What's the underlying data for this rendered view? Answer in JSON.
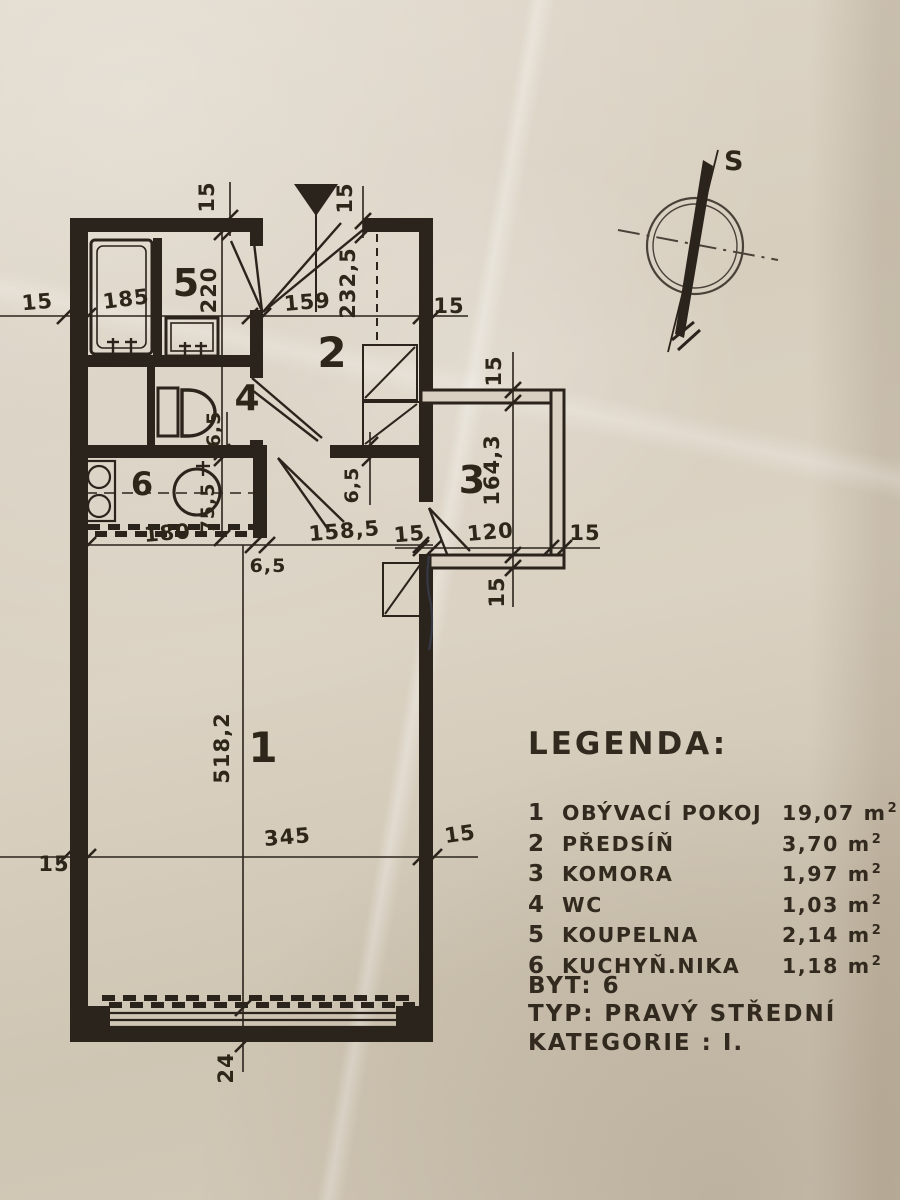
{
  "plan": {
    "rooms": [
      {
        "n": "1"
      },
      {
        "n": "2"
      },
      {
        "n": "3"
      },
      {
        "n": "4"
      },
      {
        "n": "5"
      },
      {
        "n": "6"
      }
    ],
    "dims": [
      {
        "t": "15"
      },
      {
        "t": "185"
      },
      {
        "t": "159"
      },
      {
        "t": "15"
      },
      {
        "t": "15"
      },
      {
        "t": "15"
      },
      {
        "t": "232,5"
      },
      {
        "t": "220"
      },
      {
        "t": "6,5"
      },
      {
        "t": "6,5"
      },
      {
        "t": "15"
      },
      {
        "t": "164,3"
      },
      {
        "t": "15"
      },
      {
        "t": "120"
      },
      {
        "t": "15"
      },
      {
        "t": "15"
      },
      {
        "t": "180"
      },
      {
        "t": "6,5"
      },
      {
        "t": "158,5"
      },
      {
        "t": "75,5"
      },
      {
        "t": "345"
      },
      {
        "t": "15"
      },
      {
        "t": "15"
      },
      {
        "t": "518,2"
      },
      {
        "t": "24"
      }
    ],
    "compass": {
      "label": "S"
    }
  },
  "legend": {
    "title": "LEGENDA:",
    "unit_base": "m",
    "unit_exp": "2",
    "items": [
      {
        "num": "1",
        "name": "OBÝVACÍ POKOJ",
        "area": "19,07"
      },
      {
        "num": "2",
        "name": "PŘEDSÍŇ",
        "area": "3,70"
      },
      {
        "num": "3",
        "name": "KOMORA",
        "area": "1,97"
      },
      {
        "num": "4",
        "name": "WC",
        "area": "1,03"
      },
      {
        "num": "5",
        "name": "KOUPELNA",
        "area": "2,14"
      },
      {
        "num": "6",
        "name": "KUCHYŇ.NIKA",
        "area": "1,18"
      }
    ]
  },
  "info": {
    "byt_label": "BYT:",
    "byt_value": "6",
    "typ_label": "TYP:",
    "typ_value": "PRAVÝ STŘEDNÍ",
    "kat_label": "KATEGORIE :",
    "kat_value": "I."
  }
}
